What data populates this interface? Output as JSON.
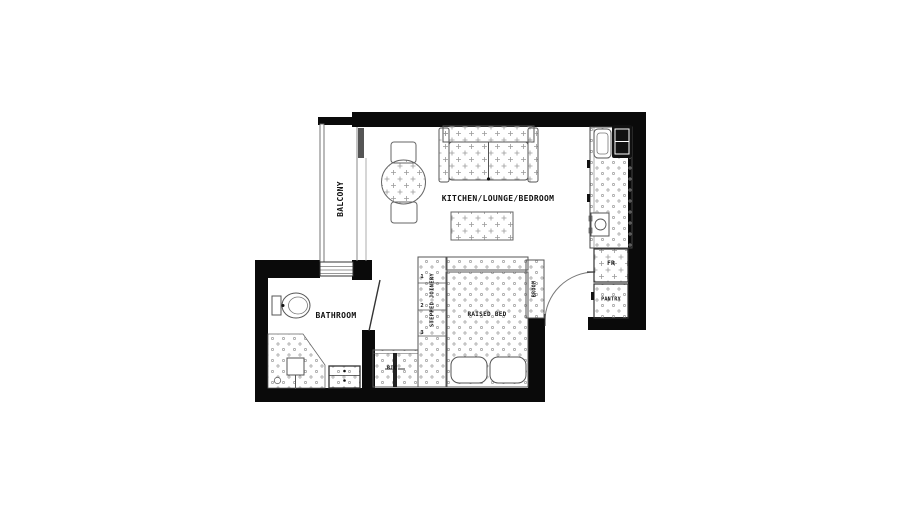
{
  "drawing": {
    "title": "studio-apartment-floor-plan",
    "rooms": {
      "balcony": "BALCONY",
      "main": "KITCHEN/LOUNGE/BEDROOM",
      "bathroom": "BATHROOM"
    },
    "fixtures": {
      "raised_bed": "RAISED BED",
      "stepped_joinery": "STEPPED JOINERY",
      "broom": "BROOM",
      "fridge": "FR",
      "pantry": "PANTRY",
      "bic": "BIC",
      "step_numbers": [
        "1",
        "2",
        "3"
      ]
    },
    "colors": {
      "wall": "#0a0a0a",
      "line": "#555555",
      "pattern": "#9a9a9a",
      "background": "#ffffff"
    }
  }
}
